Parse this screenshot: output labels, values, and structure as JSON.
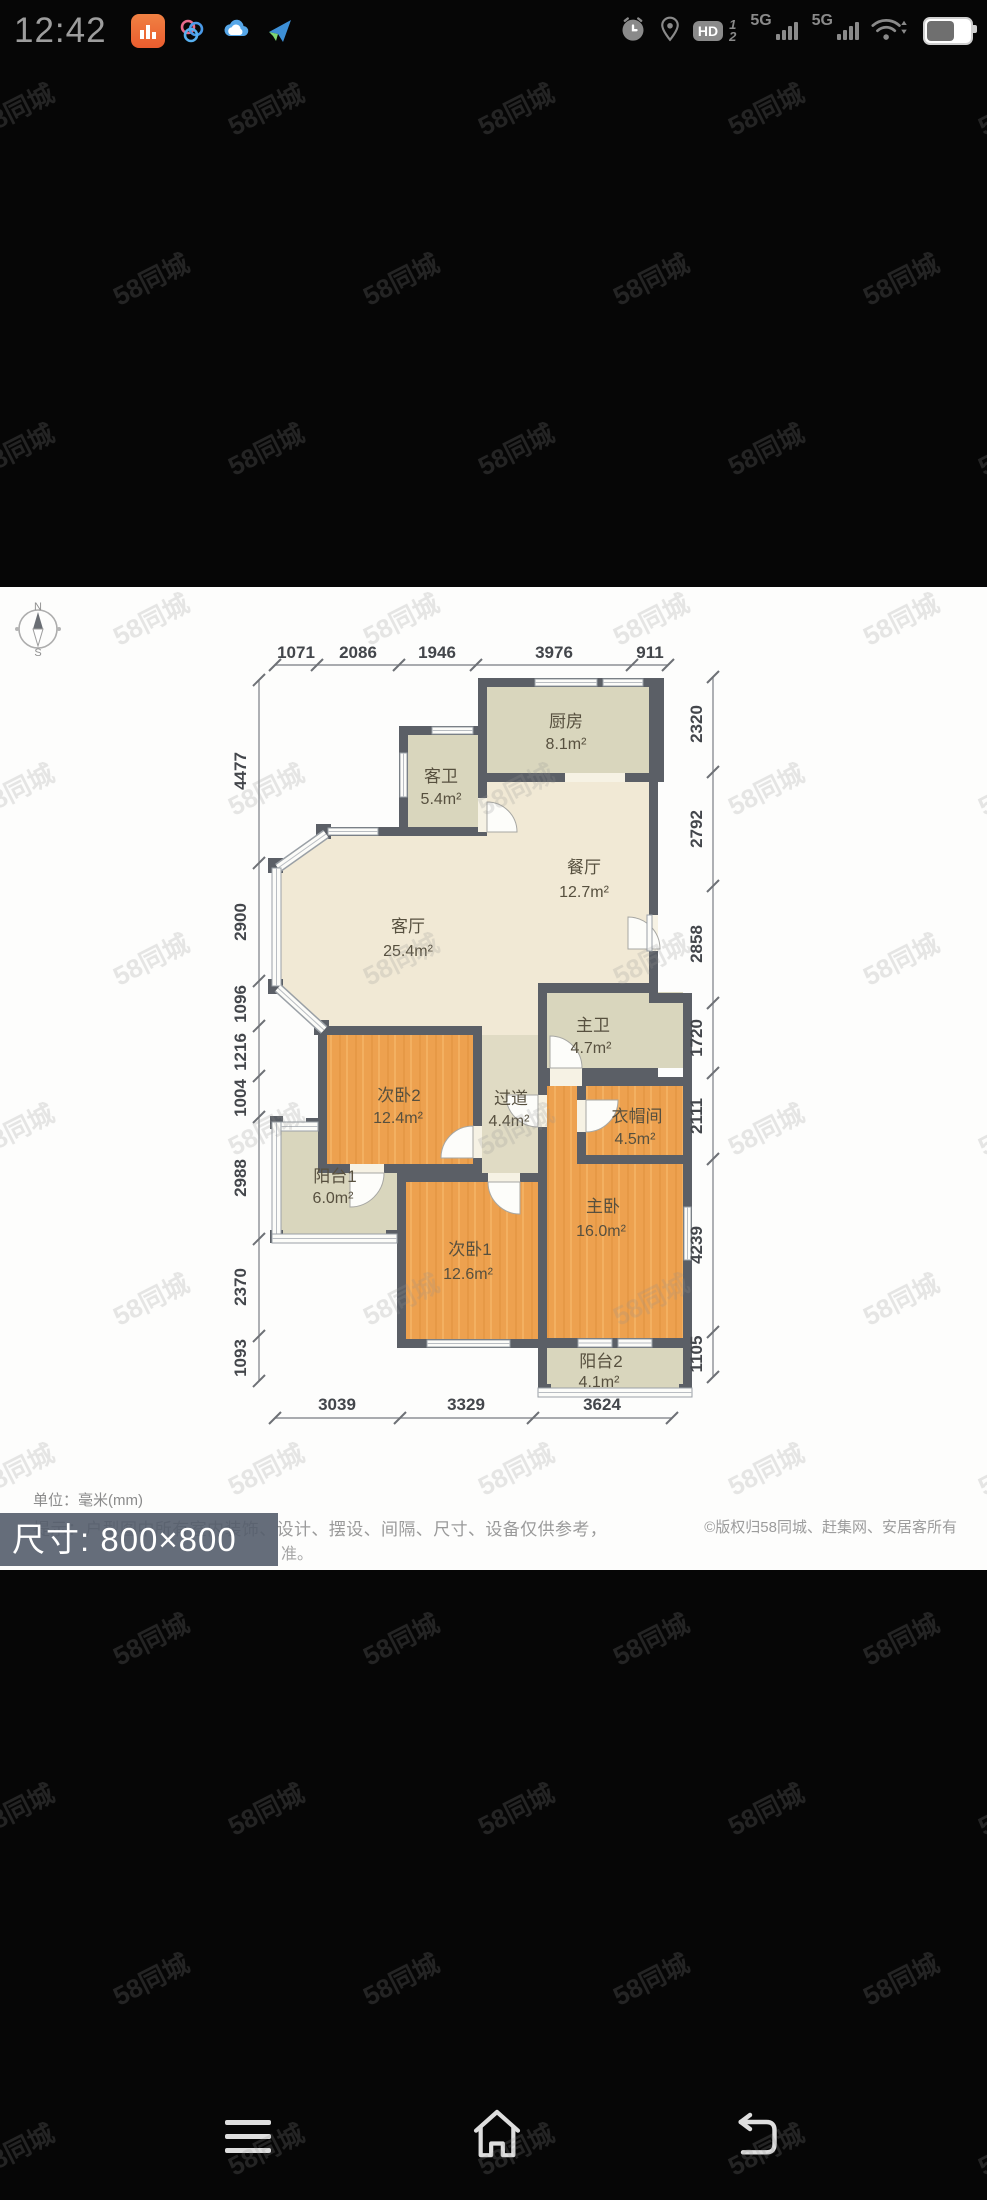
{
  "status_bar": {
    "time": "12:42",
    "hd_label": "HD",
    "hd_fraction_top": "1",
    "hd_fraction_bottom": "2",
    "network_label_1": "5G",
    "network_label_2": "5G"
  },
  "watermark": {
    "text": "58同城"
  },
  "floorplan": {
    "compass": {
      "north": "N",
      "south": "S"
    },
    "rooms": [
      {
        "name": "厨房",
        "area": "8.1m²"
      },
      {
        "name": "客卫",
        "area": "5.4m²"
      },
      {
        "name": "餐厅",
        "area": "12.7m²"
      },
      {
        "name": "客厅",
        "area": "25.4m²"
      },
      {
        "name": "主卫",
        "area": "4.7m²"
      },
      {
        "name": "次卧2",
        "area": "12.4m²"
      },
      {
        "name": "过道",
        "area": "4.4m²"
      },
      {
        "name": "衣帽间",
        "area": "4.5m²"
      },
      {
        "name": "阳台1",
        "area": "6.0m²"
      },
      {
        "name": "主卧",
        "area": "16.0m²"
      },
      {
        "name": "次卧1",
        "area": "12.6m²"
      },
      {
        "name": "阳台2",
        "area": "4.1m²"
      }
    ],
    "dims": {
      "top": [
        "1071",
        "2086",
        "1946",
        "3976",
        "911"
      ],
      "left": [
        "4477",
        "2900",
        "1096",
        "1216",
        "1004",
        "2988",
        "2370",
        "1093"
      ],
      "right": [
        "2320",
        "2792",
        "2858",
        "1720",
        "2111",
        "4239",
        "1105"
      ],
      "bottom": [
        "3039",
        "3329",
        "3624"
      ]
    }
  },
  "footer": {
    "unit_note": "单位：毫米(mm)",
    "disclaimer": "提示：户型图中所有室内装饰、设计、摆设、间隔、尺寸、设备仅供参考，",
    "disclaimer_fragment": "准。",
    "copyright": "©版权归58同城、赶集网、安居客所有",
    "size_badge": "尺寸: 800×800"
  }
}
